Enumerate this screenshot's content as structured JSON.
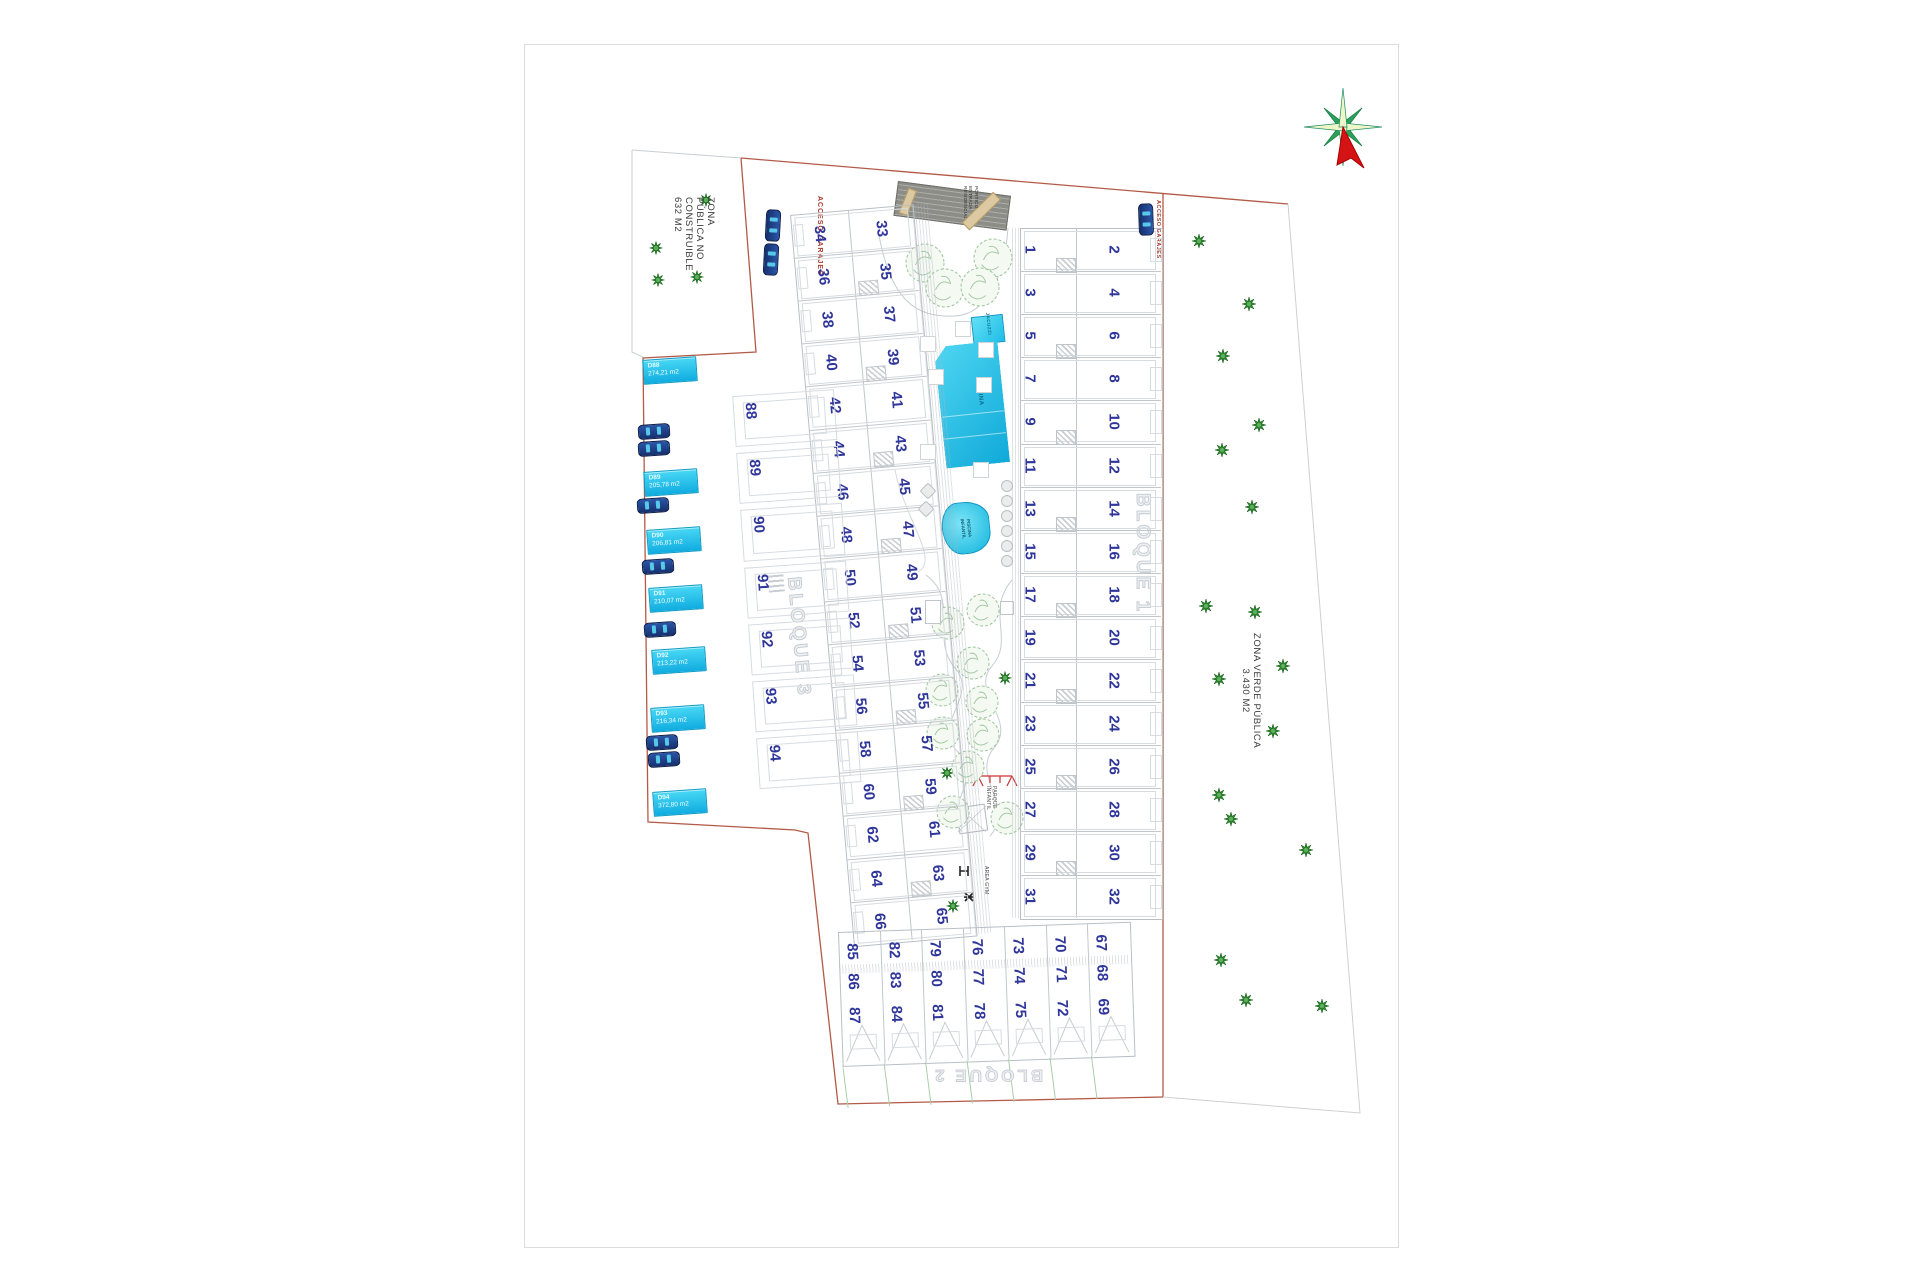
{
  "page": {
    "background": "#ffffff"
  },
  "labels": {
    "zona_publica": [
      "ZONA",
      "PÚBLICA NO",
      "CONSTRUIBLE",
      "632 M2"
    ],
    "zona_verde": [
      "ZONA VERDE PÚBLICA",
      "3.430 M2"
    ],
    "bloque_1": "BLOQUE 1",
    "bloque_2": "BLOQUE 2",
    "bloque_3": "BLOQUE 3",
    "acceso_garajes_left": "ACCESO GARAJES",
    "acceso_garajes_right": "ACCESO GARAJES",
    "portico": [
      "PÓRTICO",
      "ENTRADA",
      "RESIDENCIAL"
    ],
    "piscina": "PISCINA",
    "jacuzzi": "JACUZZI",
    "piscina_infantil": [
      "PISCINA",
      "INFANTIL"
    ],
    "parque_infantil": [
      "PARQUE",
      "INFANTIL"
    ],
    "area_gym": "AREA GYM"
  },
  "bloque1": {
    "odd": [
      1,
      3,
      5,
      7,
      9,
      11,
      13,
      15,
      17,
      19,
      21,
      23,
      25,
      27,
      29,
      31
    ],
    "even": [
      2,
      4,
      6,
      8,
      10,
      12,
      14,
      16,
      18,
      20,
      22,
      24,
      26,
      28,
      30,
      32
    ]
  },
  "bloque3": {
    "odd": [
      33,
      35,
      37,
      39,
      41,
      43,
      45,
      47,
      49,
      51,
      53,
      55,
      57,
      59,
      61,
      63,
      65
    ],
    "even": [
      34,
      36,
      38,
      40,
      42,
      44,
      46,
      48,
      50,
      52,
      54,
      56,
      58,
      60,
      62,
      64,
      66
    ]
  },
  "bloque2": {
    "columns": [
      [
        85,
        86,
        87
      ],
      [
        82,
        83,
        84
      ],
      [
        79,
        80,
        81
      ],
      [
        76,
        77,
        78
      ],
      [
        73,
        74,
        75
      ],
      [
        70,
        71,
        72
      ],
      [
        67,
        68,
        69
      ]
    ]
  },
  "duplex": {
    "plots": [
      "88",
      "89",
      "90",
      "91",
      "92",
      "93",
      "94"
    ],
    "chips": [
      {
        "code": "D88",
        "area": "274,21 m2"
      },
      {
        "code": "D89",
        "area": "205,78 m2"
      },
      {
        "code": "D90",
        "area": "206,81 m2"
      },
      {
        "code": "D91",
        "area": "210,07 m2"
      },
      {
        "code": "D92",
        "area": "213,22 m2"
      },
      {
        "code": "D93",
        "area": "216,34 m2"
      },
      {
        "code": "D94",
        "area": "372,80 m2"
      }
    ]
  },
  "colors": {
    "boundary": "#b35a46",
    "boundary_light": "#cfcfcf",
    "plot_number": "#2f3699",
    "chip": "#18bce4",
    "pool": "#19b8e2",
    "tree_dark": "#2e8b2e",
    "tree_light": "#9cc49c",
    "red_text": "#a93a2c",
    "portico": "#8d8d88",
    "green_line": "#a8cfa8"
  }
}
